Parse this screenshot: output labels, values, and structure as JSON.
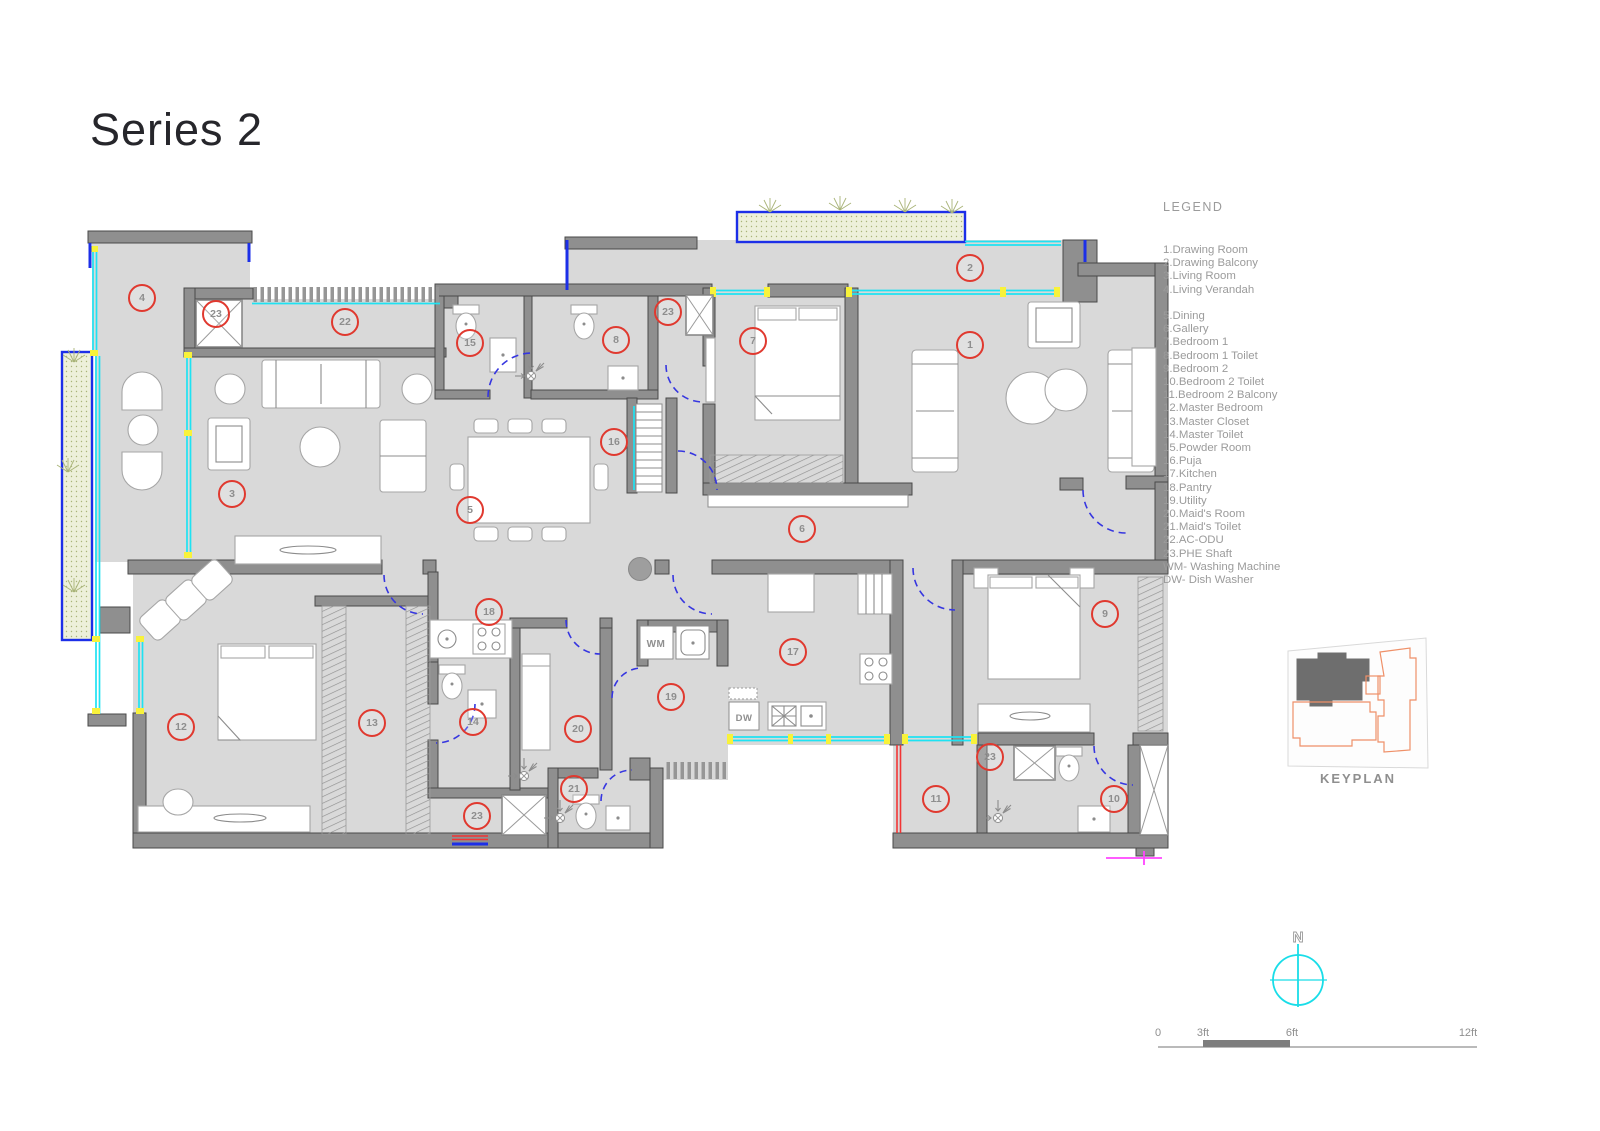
{
  "title": "Series 2",
  "legend": {
    "title": "LEGEND",
    "items": [
      "1.Drawing Room",
      "2.Drawing Balcony",
      "3.Living Room",
      "4.Living Verandah",
      "",
      "5.Dining",
      "6.Gallery",
      "7.Bedroom 1",
      "8.Bedroom 1 Toilet",
      "9.Bedroom 2",
      "10.Bedroom 2 Toilet",
      "11.Bedroom 2 Balcony",
      "12.Master Bedroom",
      "13.Master Closet",
      "14.Master Toilet",
      "15.Powder Room",
      "16.Puja",
      "17.Kitchen",
      "18.Pantry",
      "19.Utility",
      "20.Maid's Room",
      "21.Maid's Toilet",
      "22.AC-ODU",
      "23.PHE Shaft",
      "WM- Washing Machine",
      "DW- Dish Washer"
    ]
  },
  "plan": {
    "equipment": {
      "wm": "WM",
      "dw": "DW"
    },
    "markers": [
      {
        "n": "1",
        "x": 970,
        "y": 345
      },
      {
        "n": "2",
        "x": 970,
        "y": 268
      },
      {
        "n": "3",
        "x": 232,
        "y": 494
      },
      {
        "n": "4",
        "x": 142,
        "y": 298
      },
      {
        "n": "5",
        "x": 470,
        "y": 510
      },
      {
        "n": "6",
        "x": 802,
        "y": 529
      },
      {
        "n": "7",
        "x": 753,
        "y": 341
      },
      {
        "n": "8",
        "x": 616,
        "y": 340
      },
      {
        "n": "9",
        "x": 1105,
        "y": 614
      },
      {
        "n": "10",
        "x": 1114,
        "y": 799
      },
      {
        "n": "11",
        "x": 936,
        "y": 799
      },
      {
        "n": "12",
        "x": 181,
        "y": 727
      },
      {
        "n": "13",
        "x": 372,
        "y": 723
      },
      {
        "n": "14",
        "x": 473,
        "y": 722
      },
      {
        "n": "15",
        "x": 470,
        "y": 343
      },
      {
        "n": "16",
        "x": 614,
        "y": 442
      },
      {
        "n": "17",
        "x": 793,
        "y": 652
      },
      {
        "n": "18",
        "x": 489,
        "y": 612
      },
      {
        "n": "19",
        "x": 671,
        "y": 697
      },
      {
        "n": "20",
        "x": 578,
        "y": 729
      },
      {
        "n": "21",
        "x": 574,
        "y": 789
      },
      {
        "n": "22",
        "x": 345,
        "y": 322
      },
      {
        "n": "23",
        "x": 216,
        "y": 314
      },
      {
        "n": "23",
        "x": 668,
        "y": 312
      },
      {
        "n": "23",
        "x": 477,
        "y": 816
      },
      {
        "n": "23",
        "x": 990,
        "y": 757
      }
    ]
  },
  "keyplan": {
    "label": "KEYPLAN"
  },
  "north": {
    "label": "N"
  },
  "scale_bar": {
    "labels": [
      "0",
      "3ft",
      "6ft",
      "12ft"
    ]
  },
  "colors": {
    "marker_red": "#e0392f",
    "window_cyan": "#1fe2f2",
    "accent_blue": "#1c2fe8",
    "planter_green": "#edf0da",
    "wall_gray": "#8f8f8f",
    "floor_gray": "#d9d9d9",
    "keyplan_orange": "#ef9068",
    "section_magenta": "#ff44ff"
  }
}
